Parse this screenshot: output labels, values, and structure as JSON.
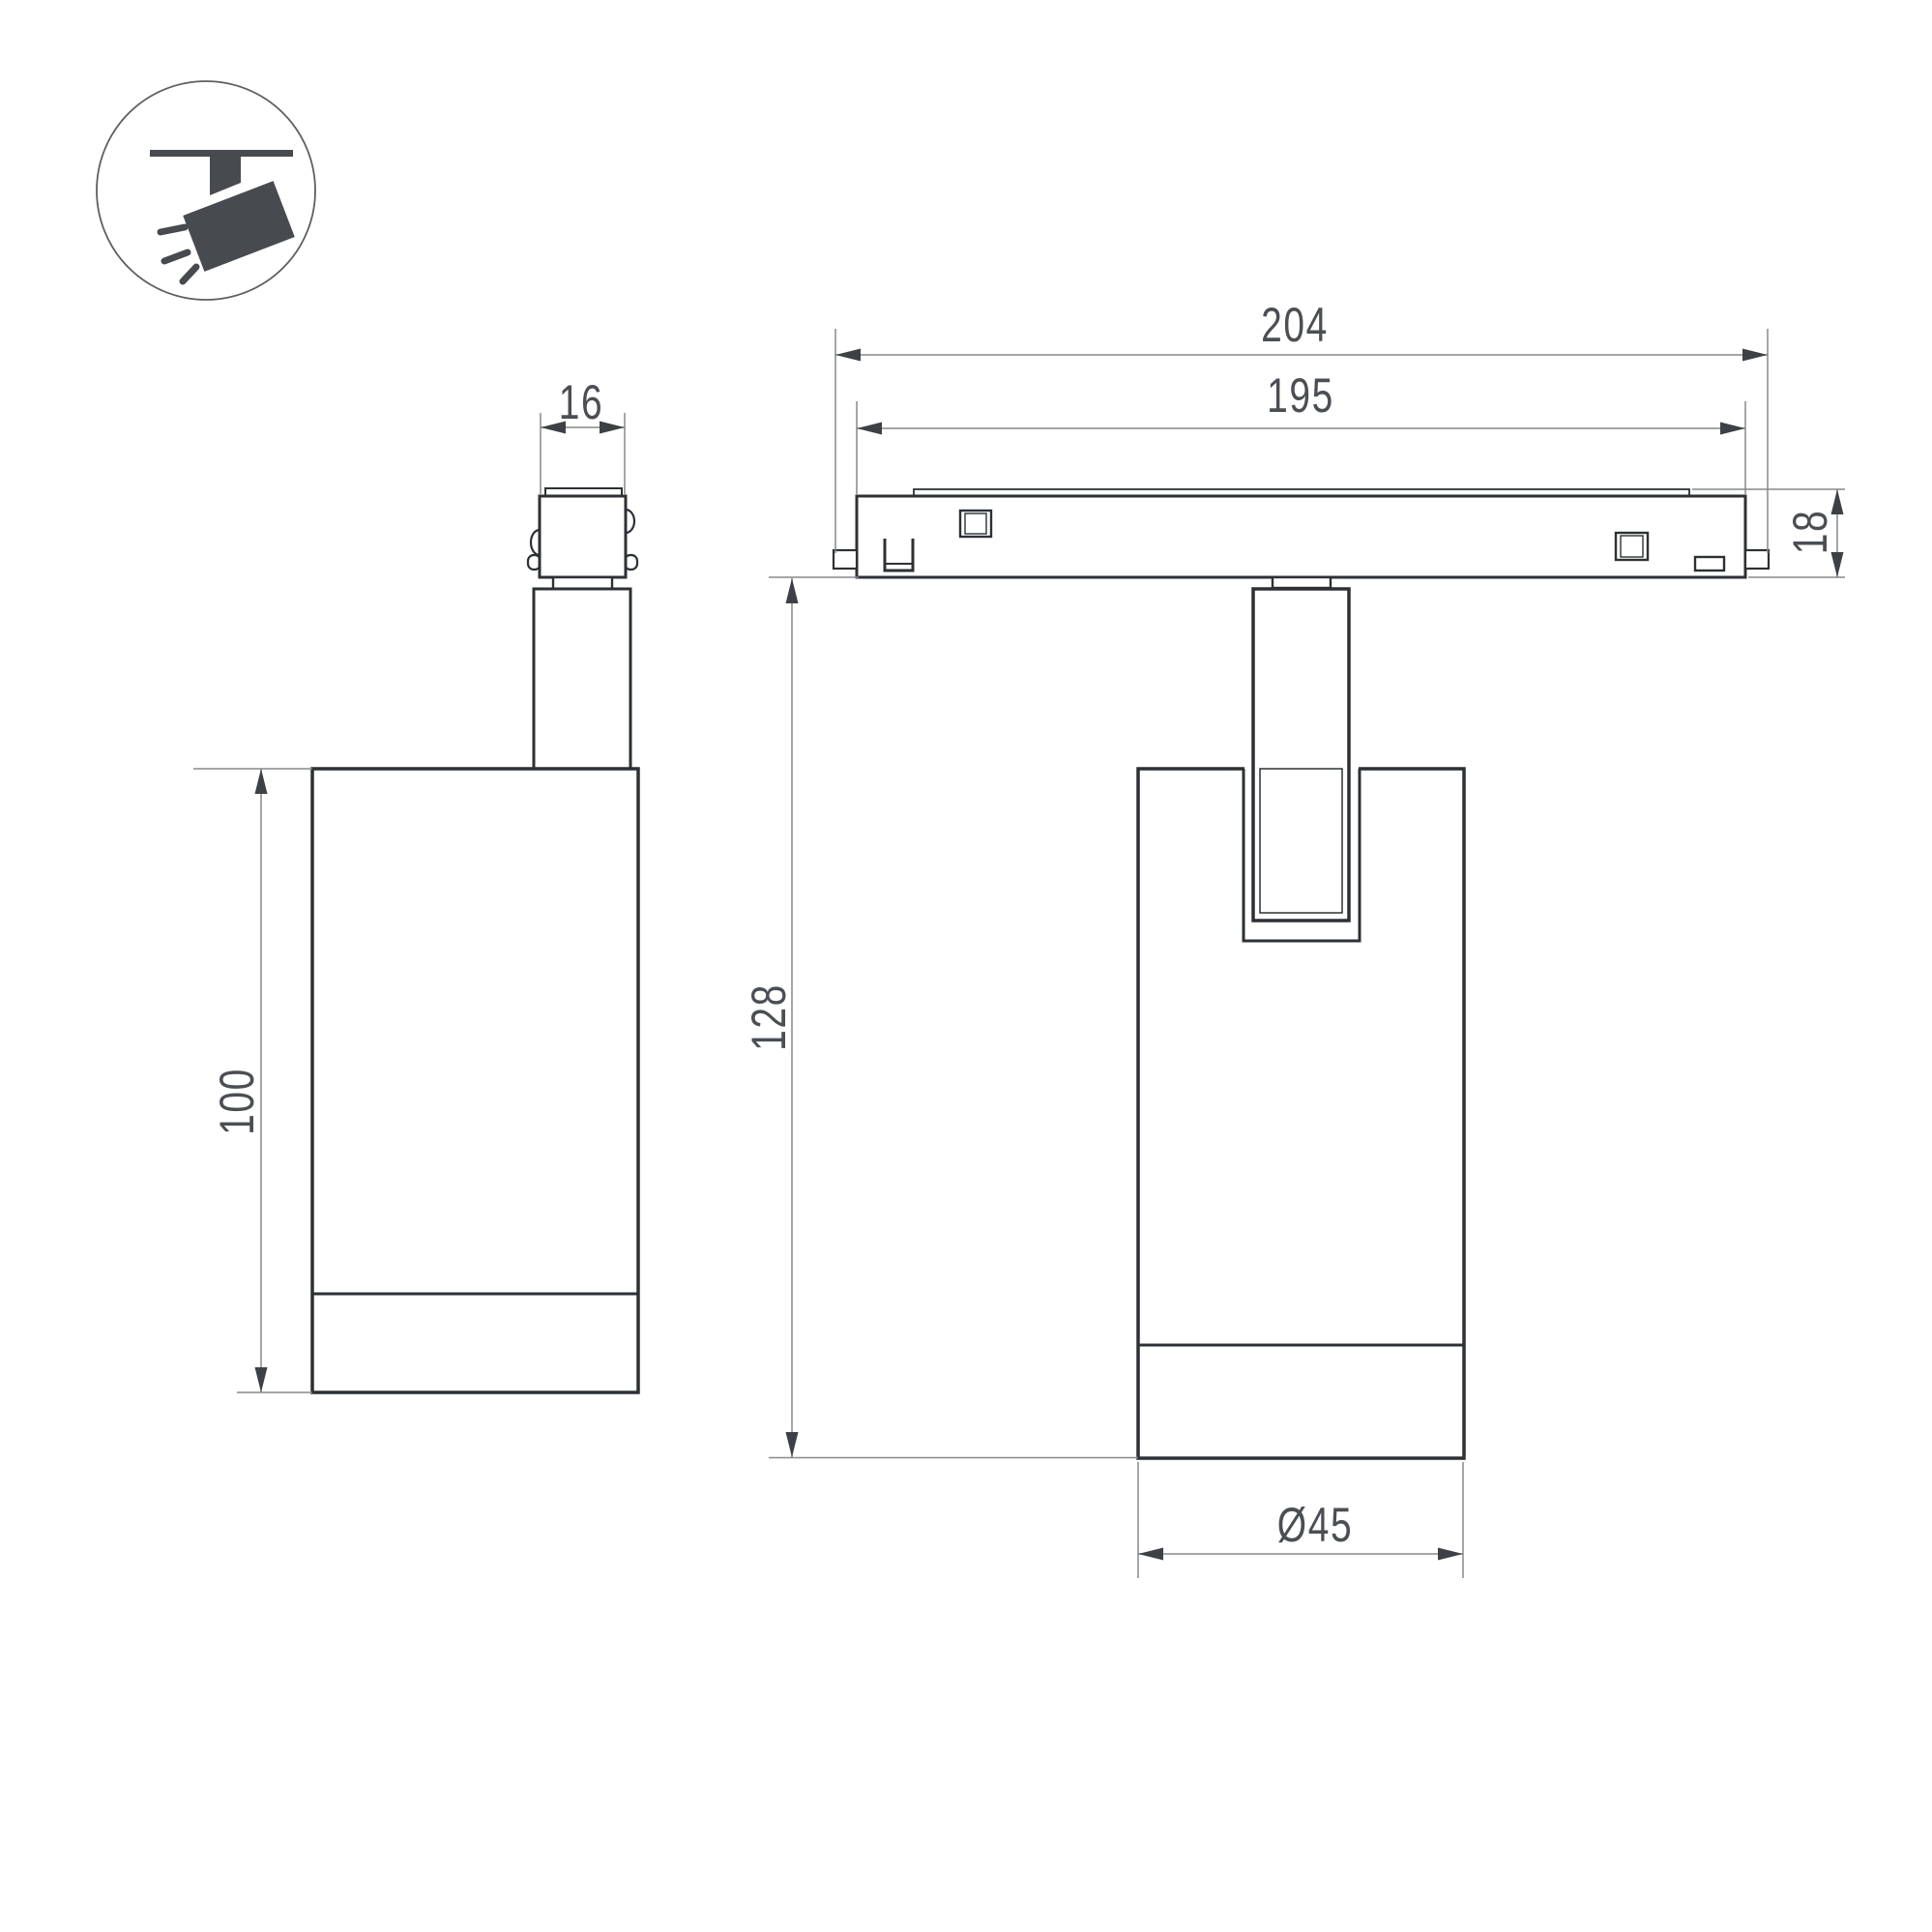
{
  "title": "Track spotlight luminaire dimension drawing",
  "colors": {
    "background": "#ffffff",
    "outline": "#2d3034",
    "dimension_line": "#85888c",
    "label_text": "#4b4e53",
    "icon_glyph": "#474a4f"
  },
  "icon": {
    "name": "ceiling-track-spotlight-pictogram"
  },
  "side_view": {
    "stem_width_label": "16",
    "body_height_label": "100"
  },
  "front_view": {
    "overall_width_label": "204",
    "track_body_width_label": "195",
    "track_height_label": "18",
    "overall_height_label": "128",
    "body_diameter_label": "Ø45"
  }
}
